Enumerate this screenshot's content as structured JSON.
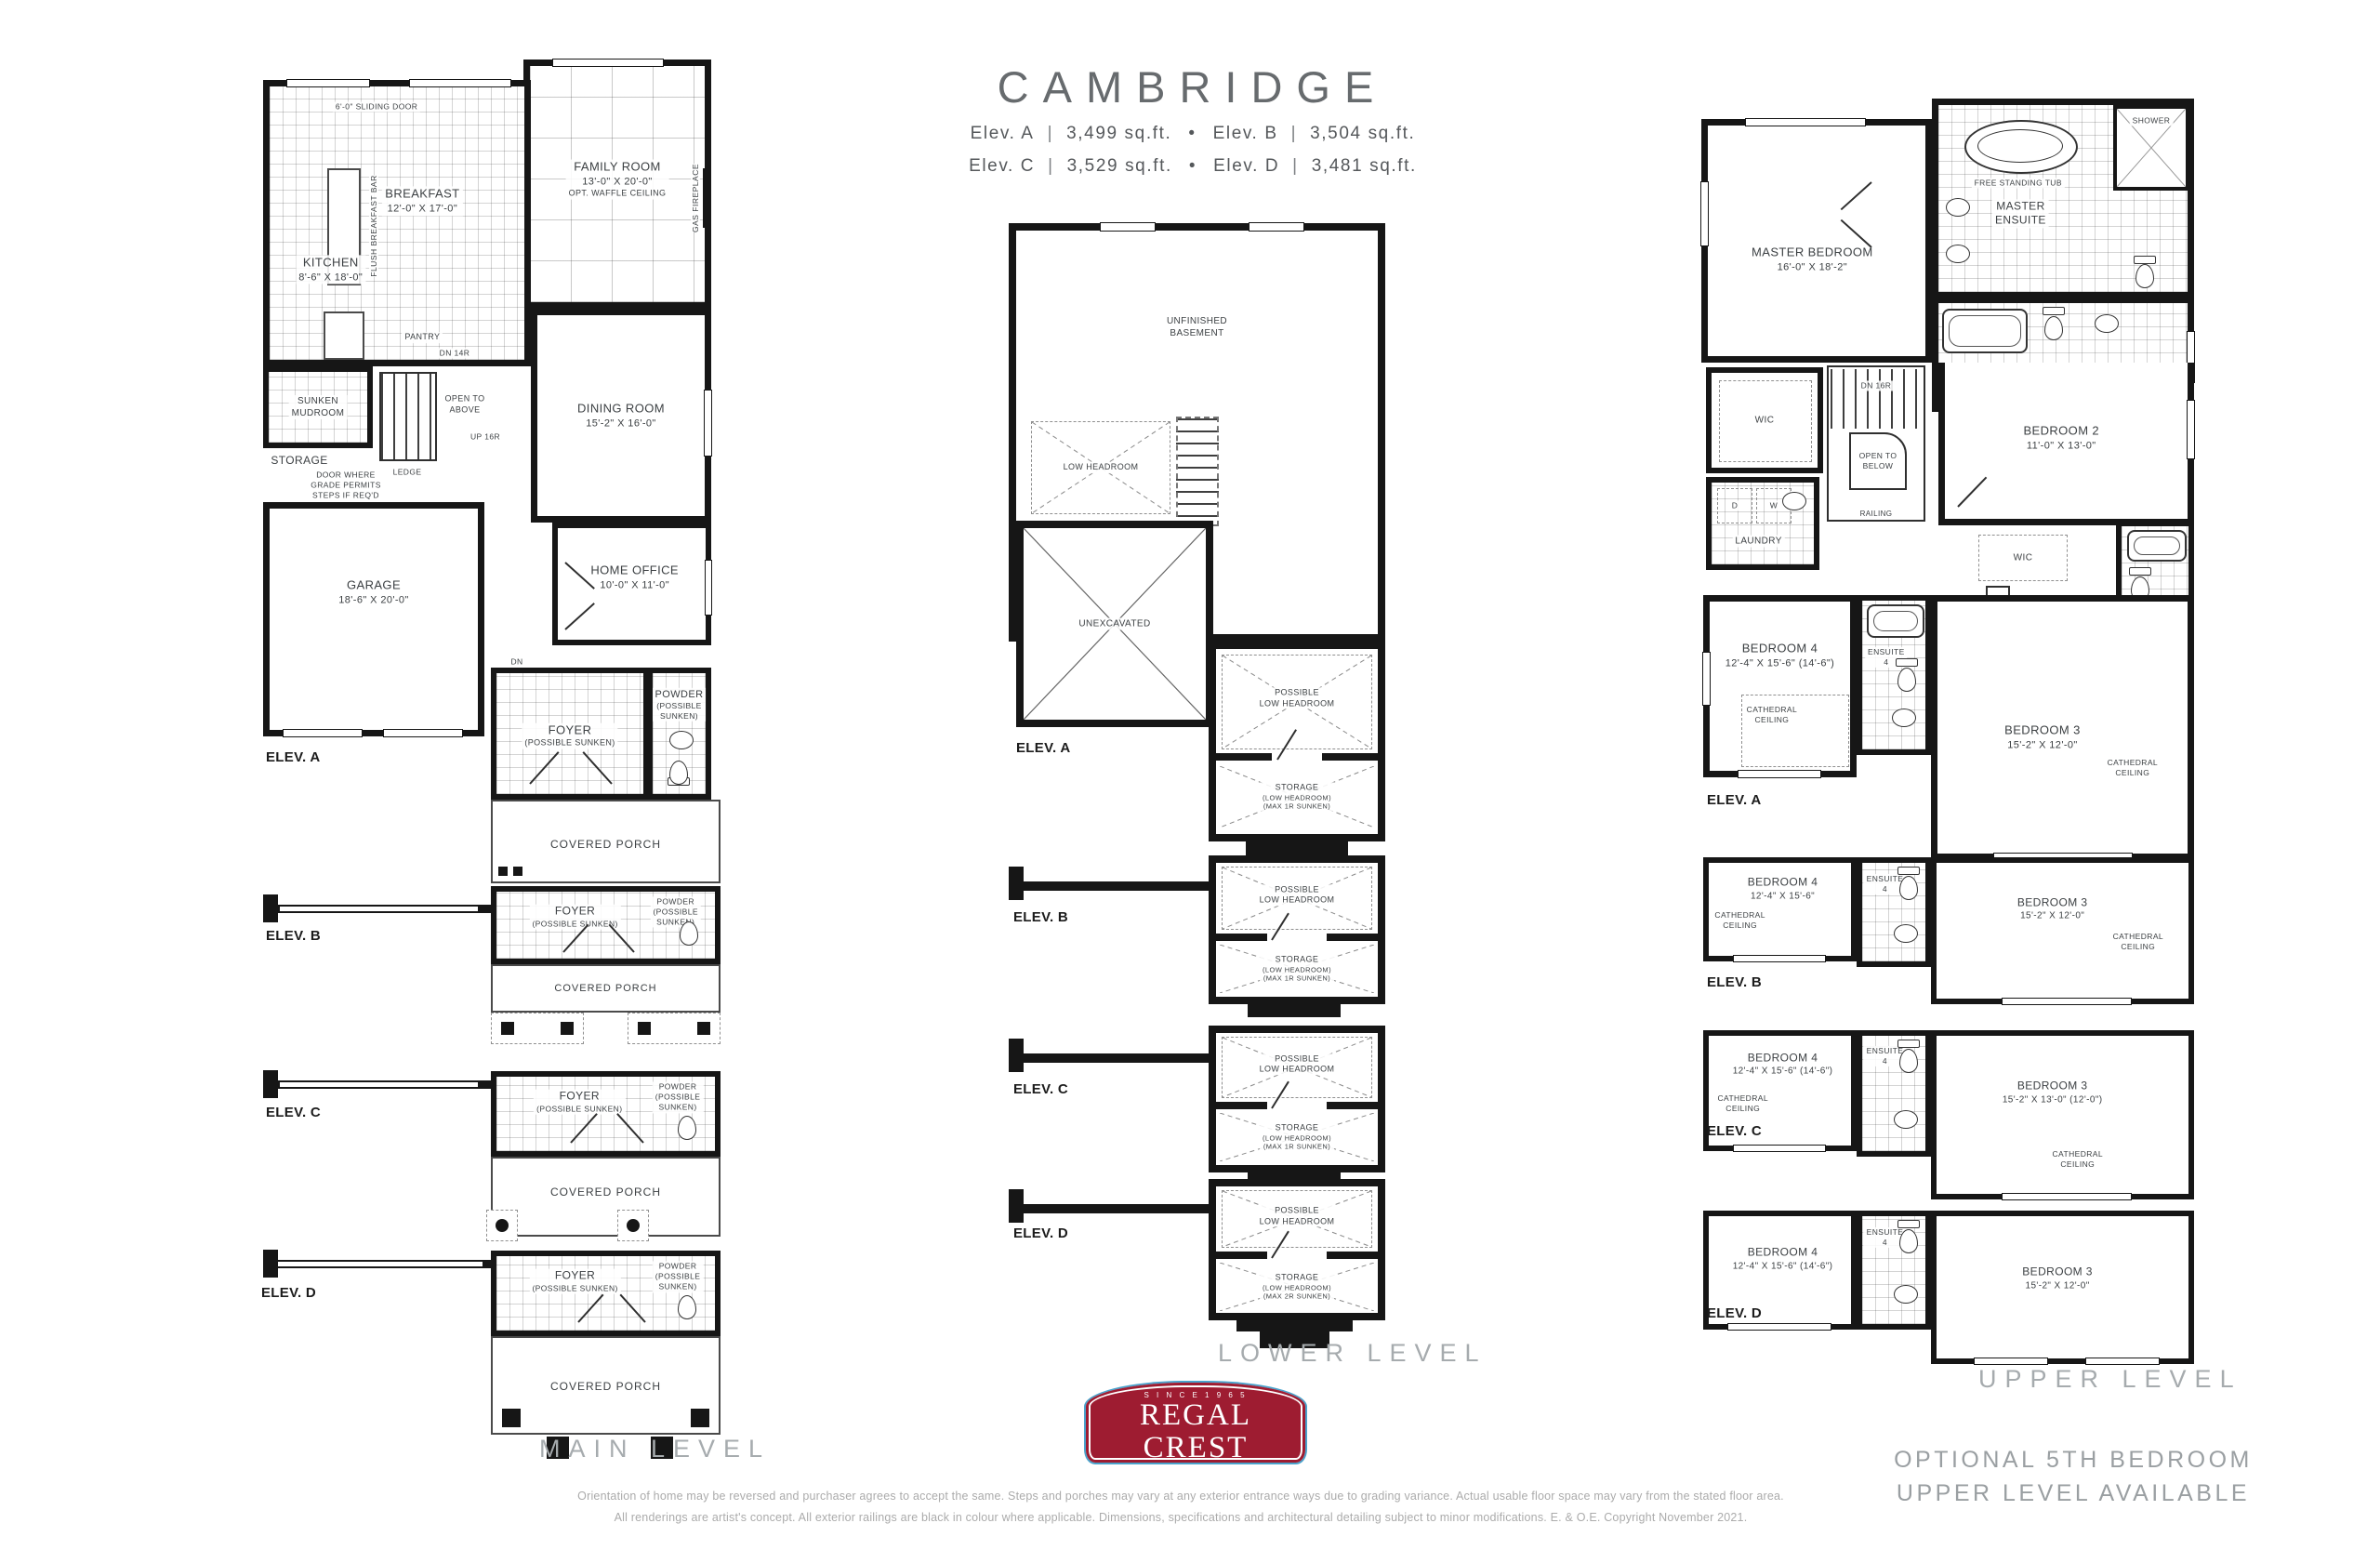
{
  "colors": {
    "wall": "#161616",
    "accent_red": "#9e1c31",
    "accent_blue": "#4aa3cc",
    "muted": "#a6abae",
    "label": "#3c4043"
  },
  "header": {
    "title": "CAMBRIDGE",
    "sep_pipe": "|",
    "sep_dot": "•",
    "elevations": [
      {
        "label": "Elev. A",
        "sqft": "3,499 sq.ft."
      },
      {
        "label": "Elev. B",
        "sqft": "3,504 sq.ft."
      },
      {
        "label": "Elev. C",
        "sqft": "3,529 sq.ft."
      },
      {
        "label": "Elev. D",
        "sqft": "3,481 sq.ft."
      }
    ]
  },
  "main": {
    "level_label": "MAIN LEVEL",
    "elev_a": "ELEV. A",
    "elev_b": "ELEV. B",
    "elev_c": "ELEV. C",
    "elev_d": "ELEV. D",
    "sliding_door": "6'-0\" SLIDING DOOR",
    "breakfast": {
      "name": "BREAKFAST",
      "dims": "12'-0\" X 17'-0\""
    },
    "flush_bar": "FLUSH BREAKFAST BAR",
    "kitchen": {
      "name": "KITCHEN",
      "dims": "8'-6\" X 18'-0\""
    },
    "family_room": {
      "name": "FAMILY ROOM",
      "dims": "13'-0\" X 20'-0\"",
      "note": "OPT. WAFFLE CEILING"
    },
    "gas_fireplace": "GAS FIREPLACE",
    "pantry": "PANTRY",
    "mudroom": {
      "line1": "SUNKEN",
      "line2": "MUDROOM"
    },
    "storage": "STORAGE",
    "door_note": {
      "line1": "DOOR WHERE",
      "line2": "GRADE PERMITS",
      "line3": "STEPS IF REQ'D"
    },
    "open_above": {
      "line1": "OPEN TO",
      "line2": "ABOVE"
    },
    "ledge": "LEDGE",
    "dn14": "DN 14R",
    "up16": "UP 16R",
    "dn": "DN",
    "steps": {
      "line1": "STEPS IF",
      "line2": "REQ'D"
    },
    "dining": {
      "name": "DINING ROOM",
      "dims": "15'-2\" X 16'-0\""
    },
    "garage": {
      "name": "GARAGE",
      "dims": "18'-6\" X 20'-0\""
    },
    "office": {
      "name": "HOME OFFICE",
      "dims": "10'-0\" X 11'-0\""
    },
    "foyer": {
      "name": "FOYER",
      "note": "(POSSIBLE SUNKEN)"
    },
    "powder": {
      "name": "POWDER",
      "note1": "(POSSIBLE",
      "note2": "SUNKEN)"
    },
    "porch": "COVERED PORCH"
  },
  "lower": {
    "level_label": "LOWER LEVEL",
    "elev_a": "ELEV. A",
    "elev_b": "ELEV. B",
    "elev_c": "ELEV. C",
    "elev_d": "ELEV. D",
    "basement": {
      "line1": "UNFINISHED",
      "line2": "BASEMENT"
    },
    "low_headroom": "LOW HEADROOM",
    "unexcavated": "UNEXCAVATED",
    "possible": {
      "line1": "POSSIBLE",
      "line2": "LOW HEADROOM"
    },
    "storage": {
      "name": "STORAGE",
      "note1": "(LOW HEADROOM)",
      "note2": "(MAX 1R SUNKEN)",
      "note2_d": "(MAX 2R SUNKEN)"
    }
  },
  "upper": {
    "level_label": "UPPER LEVEL",
    "elev_a": "ELEV. A",
    "elev_b": "ELEV. B",
    "elev_c": "ELEV. C",
    "elev_d": "ELEV. D",
    "master": {
      "name": "MASTER BEDROOM",
      "dims": "16'-0\" X 18'-2\""
    },
    "master_ensuite": {
      "line1": "MASTER",
      "line2": "ENSUITE"
    },
    "tub_label": "FREE STANDING TUB",
    "shower": "SHOWER",
    "ensuite2": "ENSUITE 2",
    "ensuite3": {
      "line1": "ENSUITE",
      "line2": "3"
    },
    "ensuite4": {
      "line1": "ENSUITE",
      "line2": "4"
    },
    "wic": "WIC",
    "linen": "LINEN",
    "open_below": {
      "line1": "OPEN TO",
      "line2": "BELOW"
    },
    "dn16": "DN 16R",
    "railing": "RAILING",
    "laundry": "LAUNDRY",
    "d": "D",
    "w": "W",
    "bedroom2": {
      "name": "BEDROOM 2",
      "dims": "11'-0\" X 13'-0\""
    },
    "bedroom3": {
      "name": "BEDROOM 3",
      "dims": "15'-2\" X 12'-0\""
    },
    "bedroom3_c": {
      "name": "BEDROOM 3",
      "dims": "15'-2\" X 13'-0\" (12'-0\")"
    },
    "bedroom4": {
      "name": "BEDROOM 4",
      "dims": "12'-4\" X 15'-6\" (14'-6\")"
    },
    "bedroom4_b": {
      "name": "BEDROOM 4",
      "dims": "12'-4\" X 15'-6\""
    },
    "cathedral": {
      "line1": "CATHEDRAL",
      "line2": "CEILING"
    },
    "optional": {
      "line1": "OPTIONAL 5TH BEDROOM",
      "line2": "UPPER LEVEL AVAILABLE"
    }
  },
  "footer": {
    "disclaimer1": "Orientation of home may be reversed and purchaser agrees to accept the same. Steps and porches may vary at any exterior entrance ways due to grading variance. Actual usable floor space may vary from the stated floor area.",
    "disclaimer2": "All renderings are artist's concept. All exterior railings are black in colour where applicable. Dimensions, specifications and architectural detailing subject to minor modifications. E. & O.E. Copyright November 2021.",
    "logo": {
      "since": "S I N C E   1 9 6 5",
      "name": "REGAL CREST",
      "homes": "H O M E S"
    }
  }
}
